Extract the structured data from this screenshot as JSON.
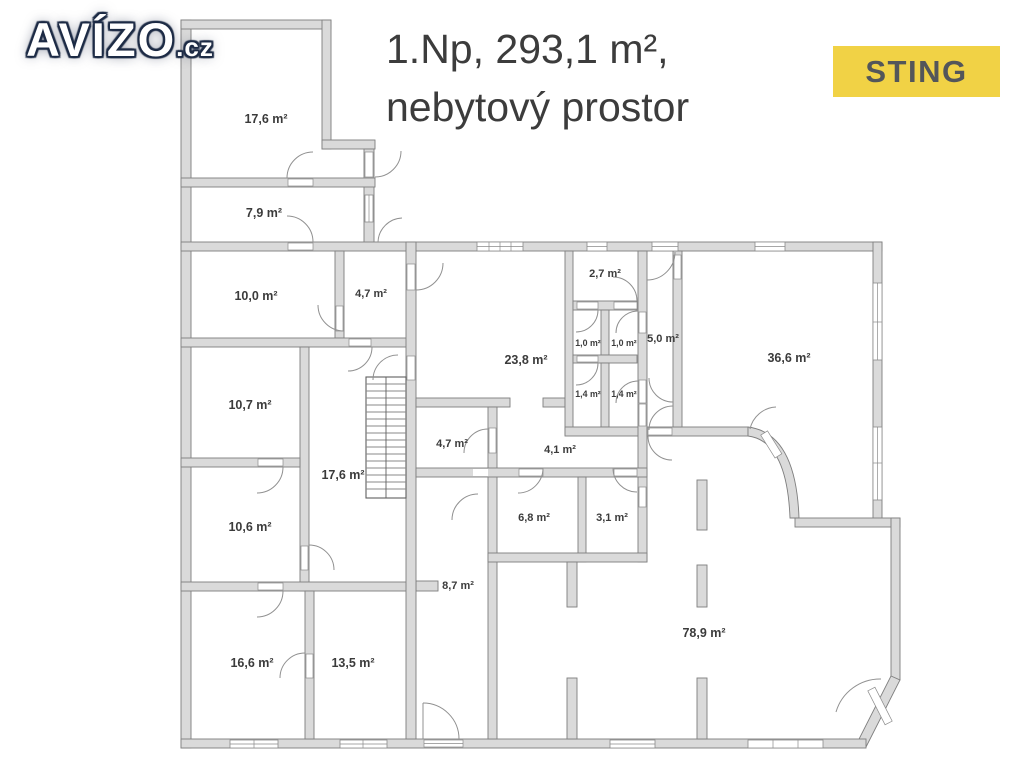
{
  "branding": {
    "logo_text": "AVÍZO",
    "logo_suffix": ".cz",
    "agency": "STING",
    "accent_yellow": "#f1d245",
    "agency_text_color": "#53565a"
  },
  "header": {
    "title_line1": "1.Np, 293,1 m²,",
    "title_line2": "nebytový prostor"
  },
  "floorplan": {
    "wall_color": "#dadada",
    "outline_color": "#7e7e7e",
    "label_color": "#3b3b3b",
    "rooms": [
      {
        "name": "room-top-17-6",
        "label": "17,6 m²"
      },
      {
        "name": "room-7-9",
        "label": "7,9 m²"
      },
      {
        "name": "room-10-0",
        "label": "10,0 m²"
      },
      {
        "name": "room-4-7-top",
        "label": "4,7 m²"
      },
      {
        "name": "room-10-7",
        "label": "10,7 m²"
      },
      {
        "name": "hallway-17-6",
        "label": "17,6 m²"
      },
      {
        "name": "room-10-6",
        "label": "10,6 m²"
      },
      {
        "name": "room-16-6",
        "label": "16,6 m²"
      },
      {
        "name": "room-13-5",
        "label": "13,5 m²"
      },
      {
        "name": "corridor-8-7",
        "label": "8,7 m²"
      },
      {
        "name": "room-23-8",
        "label": "23,8 m²"
      },
      {
        "name": "room-2-7",
        "label": "2,7 m²"
      },
      {
        "name": "wc-1-0-a",
        "label": "1,0 m²"
      },
      {
        "name": "wc-1-0-b",
        "label": "1,0 m²"
      },
      {
        "name": "corridor-5-0",
        "label": "5,0 m²"
      },
      {
        "name": "wc-1-4-a",
        "label": "1,4 m²"
      },
      {
        "name": "wc-1-4-b",
        "label": "1,4 m²"
      },
      {
        "name": "room-4-7-mid",
        "label": "4,7 m²"
      },
      {
        "name": "hall-4-1",
        "label": "4,1 m²"
      },
      {
        "name": "room-6-8",
        "label": "6,8 m²"
      },
      {
        "name": "room-3-1",
        "label": "3,1 m²"
      },
      {
        "name": "room-36-6",
        "label": "36,6 m²"
      },
      {
        "name": "room-78-9",
        "label": "78,9 m²"
      }
    ]
  }
}
